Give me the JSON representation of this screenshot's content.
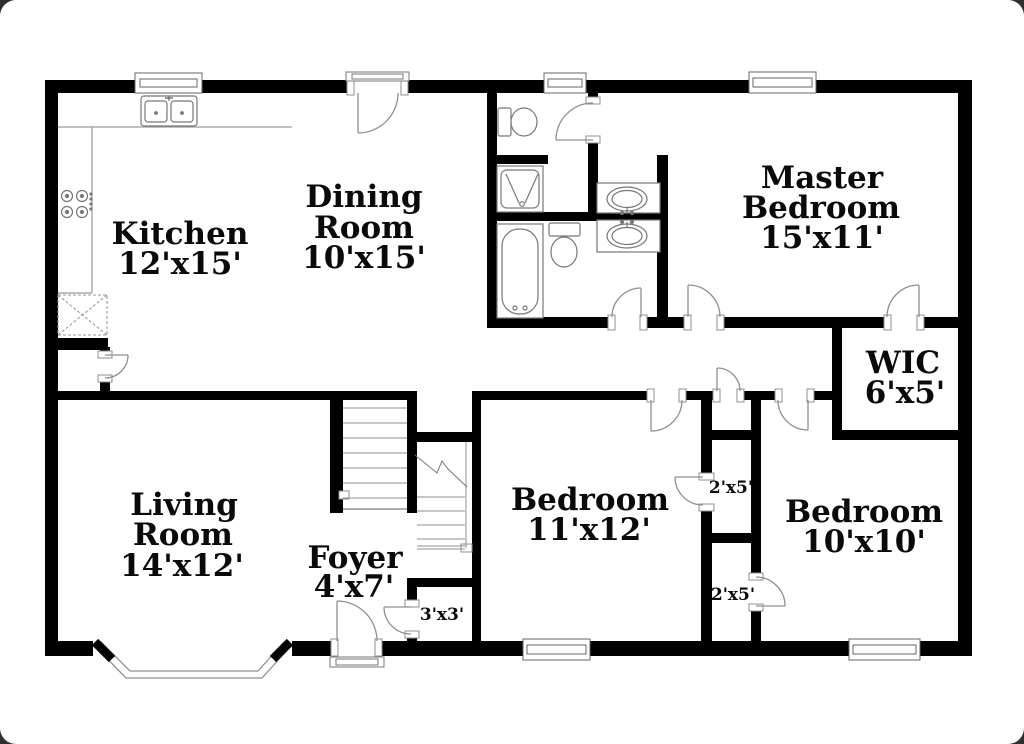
{
  "colors": {
    "background": "#ffffff",
    "wall": "#000000",
    "fixture_line": "#8f8f8f",
    "text": "#0a0a0a"
  },
  "rooms": {
    "kitchen": {
      "name": "Kitchen",
      "dims": "12'x15'"
    },
    "dining_room": {
      "name_line1": "Dining",
      "name_line2": "Room",
      "dims": "10'x15'"
    },
    "master_bedroom": {
      "name_line1": "Master",
      "name_line2": "Bedroom",
      "dims": "15'x11'"
    },
    "wic": {
      "name": "WIC",
      "dims": "6'x5'"
    },
    "living_room": {
      "name_line1": "Living",
      "name_line2": "Room",
      "dims": "14'x12'"
    },
    "foyer": {
      "name": "Foyer",
      "dims": "4'x7'"
    },
    "bedroom_11x12": {
      "name": "Bedroom",
      "dims": "11'x12'"
    },
    "bedroom_10x10": {
      "name": "Bedroom",
      "dims": "10'x10'"
    },
    "closet_upper": {
      "dims": "2'x5'"
    },
    "closet_lower": {
      "dims": "2'x5'"
    },
    "foyer_closet": {
      "dims": "3'x3'"
    }
  },
  "fixtures": [
    "double-kitchen-sink",
    "range-burners",
    "refrigerator",
    "shower-stall",
    "bathtub",
    "toilet",
    "toilet",
    "vanity-sink",
    "vanity-sink",
    "staircase",
    "bay-window",
    "front-door",
    "back-door",
    "windows"
  ]
}
